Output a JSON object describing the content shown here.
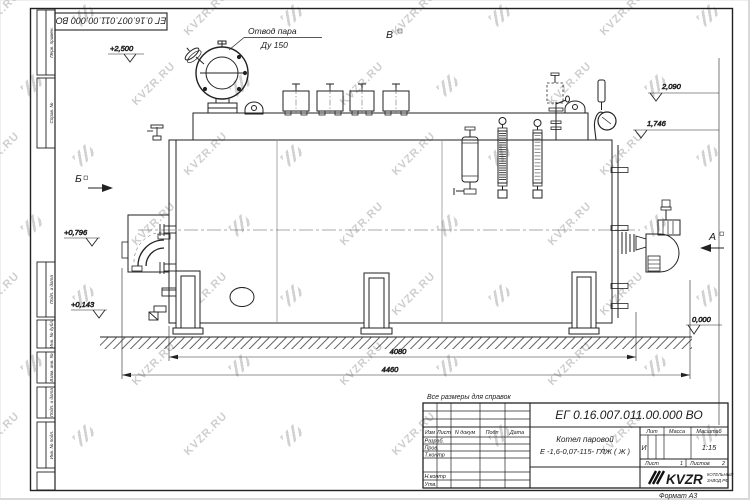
{
  "watermark": {
    "text": "KVZR.RU"
  },
  "colors": {
    "line": "#222222",
    "watermark": "#c6c6c6",
    "brand_sub": "#8d3b2f"
  },
  "frame": {
    "doc_number_top": "ЕГ 0.16.007.011.00.000  ВО",
    "format_label": "Формат А3",
    "stamp_columns": [
      "Перв. примен.",
      "Справ. №",
      "Подп. и дата",
      "Инв. № дубл.",
      "Взам. инв. №",
      "Подп. и дата",
      "Инв. № подл."
    ]
  },
  "drawing": {
    "note": "Все размеры для справок",
    "steam_callout_line1": "Отвод пара",
    "steam_callout_line2": "Ду 150",
    "view_top": "В",
    "view_left": "Б",
    "view_right": "А",
    "level_top": "+2,500",
    "level_mid": "+0,796",
    "level_low": "+0,143",
    "level_right_upper": "2,090",
    "level_right_lower": "1,746",
    "level_ground": "0,000",
    "dim_inner": "4080",
    "dim_outer": "4460"
  },
  "title_block": {
    "doc_number": "ЕГ 0.16.007.011.00.000  ВО",
    "name_line1": "Котел паровой",
    "name_line2": "Е -1,6-0,07-115- ГЛЖ ( Ж )",
    "col_izm": "Изм",
    "col_list": "Лист",
    "col_doc": "N докум",
    "col_podp": "Подп",
    "col_data": "Дата",
    "row_razrab": "Разраб.",
    "row_prov": "Пров.",
    "row_tkontr": "Т.контр",
    "row_nkontr": "Н.контр",
    "row_utv": "Утв.",
    "lit_label": "Лит",
    "mass_label": "Масса",
    "scale_label": "Масштаб",
    "lit_value": "И",
    "scale_value": "1:15",
    "sheet_label": "Лист",
    "sheet_value": "1",
    "sheets_label": "Листов",
    "sheets_value": "2",
    "brand": "KVZR",
    "brand_sub1": "КОТЕЛЬНЫЙ",
    "brand_sub2": "ЗАВОД РФ"
  }
}
